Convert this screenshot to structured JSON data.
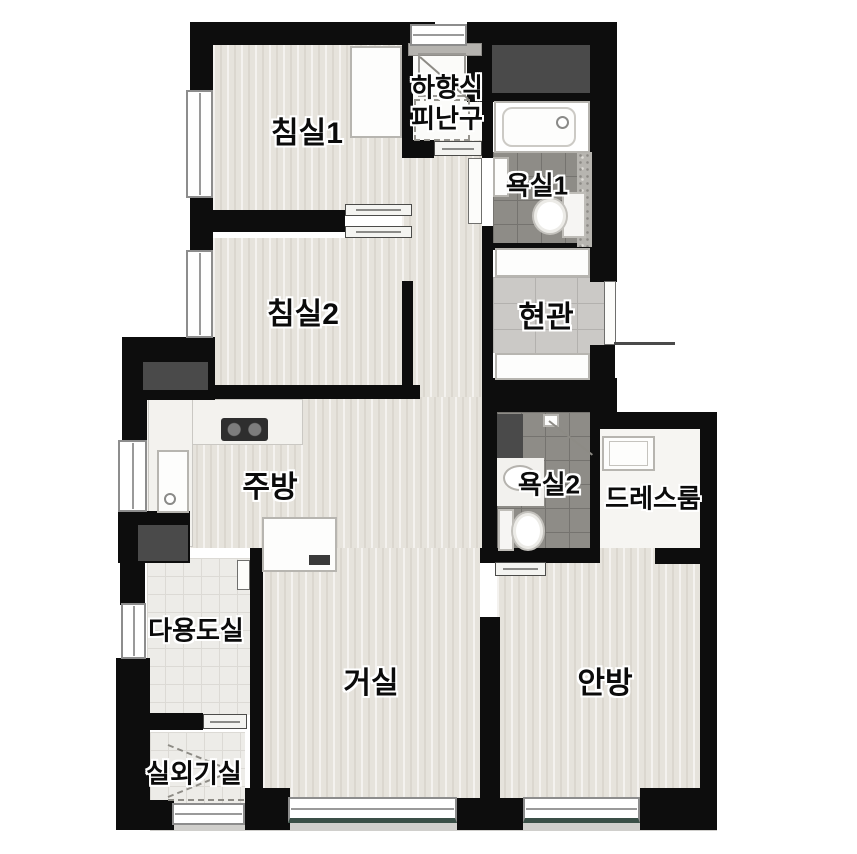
{
  "title": "아파트 평면도",
  "colors": {
    "wall": "#0d0d0d",
    "wood_floor": "#e6e3dc",
    "bath_tile": "#8e8c87",
    "entry_tile": "#cbc9c6",
    "utility_tile": "#edece8",
    "white_floor": "#f6f5f2",
    "duct": "#4a4a4a",
    "balcony_band": "#d0cfcc",
    "window_frame": "#8d8d8d",
    "window_accent": "#3a4f47"
  },
  "rooms": [
    {
      "id": "bedroom1",
      "label": "침실1"
    },
    {
      "id": "bedroom2",
      "label": "침실2"
    },
    {
      "id": "evacuation-hatch",
      "label": "하향식 피난구",
      "line1": "하향식",
      "line2": "피난구"
    },
    {
      "id": "bathroom1",
      "label": "욕실1"
    },
    {
      "id": "entrance",
      "label": "현관"
    },
    {
      "id": "kitchen",
      "label": "주방"
    },
    {
      "id": "bathroom2",
      "label": "욕실2"
    },
    {
      "id": "dressroom",
      "label": "드레스룸"
    },
    {
      "id": "utility-room",
      "label": "다용도실"
    },
    {
      "id": "living-room",
      "label": "거실"
    },
    {
      "id": "master-bedroom",
      "label": "안방"
    },
    {
      "id": "outdoor-unit-room",
      "label": "실외기실"
    }
  ]
}
